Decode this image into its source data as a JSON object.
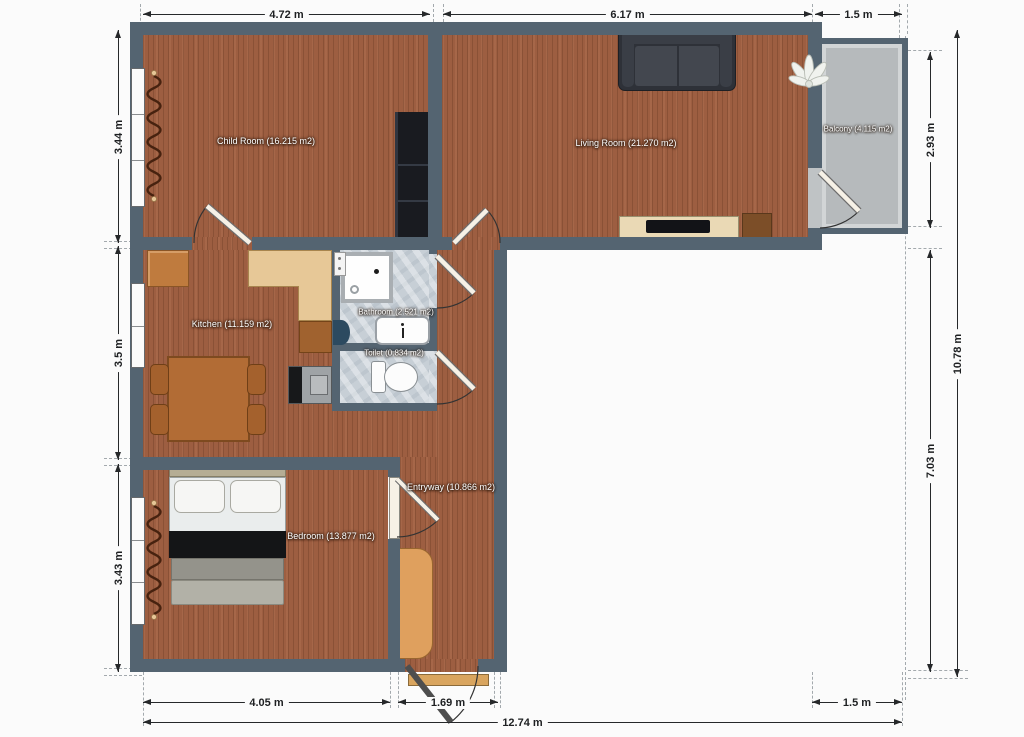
{
  "plan": {
    "rooms": [
      {
        "id": "child-room",
        "label": "Child Room (16.215 m2)"
      },
      {
        "id": "living-room",
        "label": "Living Room (21.270 m2)"
      },
      {
        "id": "balcony",
        "label": "Balcony (4.115 m2)"
      },
      {
        "id": "kitchen",
        "label": "Kitchen (11.159 m2)"
      },
      {
        "id": "bathroom",
        "label": "Bathroom (2.521 m2)"
      },
      {
        "id": "toilet",
        "label": "Toilet (0.834 m2)"
      },
      {
        "id": "entryway",
        "label": "Entryway (10.866 m2)"
      },
      {
        "id": "bedroom",
        "label": "Bedroom (13.877 m2)"
      }
    ],
    "dims": {
      "top": [
        "4.72 m",
        "6.17 m",
        "1.5 m"
      ],
      "left": [
        "3.44 m",
        "3.5 m",
        "3.43 m"
      ],
      "right": [
        "2.93 m",
        "10.78 m",
        "7.03 m"
      ],
      "bottom": [
        "4.05 m",
        "1.69 m",
        "1.5 m",
        "12.74 m"
      ]
    }
  },
  "colors": {
    "bg": "#fbfbfb",
    "wall": "#546471",
    "wood": "#9d5e41",
    "tile": "#c7cfd6",
    "balcony": "#b6babc"
  }
}
